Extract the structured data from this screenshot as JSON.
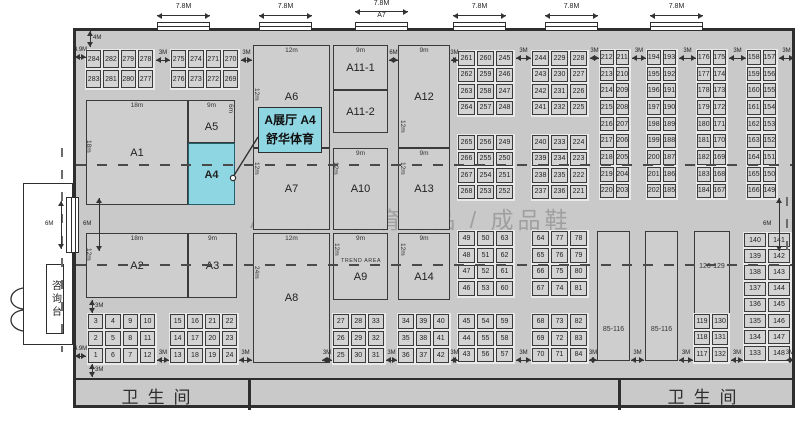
{
  "watermark": {
    "left": "A展厅",
    "right": "体育用品 / 成品鞋"
  },
  "callout": {
    "line1": "A展厅 A4",
    "line2": "舒华体育",
    "target": "A4"
  },
  "annex": {
    "desk_label": "咨询台",
    "door_dim": "6M"
  },
  "restroom": {
    "left_label": "卫生间",
    "right_label": "卫生间",
    "dividers": [
      248,
      618
    ]
  },
  "trend_area_label": "TREND AREA",
  "colors": {
    "hall_bg": "#c9c9c9",
    "booth_bg": "#d3d3d3",
    "highlight": "#8fd6e3",
    "wall": "#2e2e2e",
    "watermark": "#a0a0a0"
  },
  "top_doors": {
    "width_label": "7.8M",
    "a7_label": "A7",
    "items": [
      {
        "x": 157
      },
      {
        "x": 259
      },
      {
        "x": 355,
        "sub": "A7"
      },
      {
        "x": 453
      },
      {
        "x": 545
      },
      {
        "x": 650
      }
    ]
  },
  "zones": [
    {
      "id": "A1",
      "x": 86,
      "y": 100,
      "w": 102,
      "h": 105,
      "label": "A1",
      "t": "18m"
    },
    {
      "id": "A5",
      "x": 188,
      "y": 100,
      "w": 47,
      "h": 43,
      "label": "A5",
      "t": "9m",
      "ly": 0.62
    },
    {
      "id": "A4",
      "x": 188,
      "y": 143,
      "w": 47,
      "h": 62,
      "label": "A4",
      "hl": true,
      "ly": 0.52,
      "bold": true
    },
    {
      "id": "A2",
      "x": 86,
      "y": 233,
      "w": 102,
      "h": 65,
      "label": "A2",
      "t": "18m"
    },
    {
      "id": "A3",
      "x": 188,
      "y": 233,
      "w": 49,
      "h": 65,
      "label": "A3",
      "t": "9m"
    },
    {
      "id": "A6",
      "x": 253,
      "y": 45,
      "w": 77,
      "h": 103,
      "label": "A6",
      "t": "12m"
    },
    {
      "id": "A7",
      "x": 253,
      "y": 148,
      "w": 77,
      "h": 82,
      "label": "A7"
    },
    {
      "id": "A8",
      "x": 253,
      "y": 233,
      "w": 77,
      "h": 130,
      "label": "A8",
      "t": "12m"
    },
    {
      "id": "A11-1",
      "x": 333,
      "y": 45,
      "w": 55,
      "h": 45,
      "label": "A11-1",
      "t": "9m"
    },
    {
      "id": "A11-2",
      "x": 333,
      "y": 90,
      "w": 55,
      "h": 43,
      "label": "A11-2"
    },
    {
      "id": "A10",
      "x": 333,
      "y": 148,
      "w": 55,
      "h": 82,
      "label": "A10",
      "t": "9m"
    },
    {
      "id": "A9",
      "x": 333,
      "y": 233,
      "w": 55,
      "h": 67,
      "label": "A9",
      "t": "9m",
      "ly": 0.66
    },
    {
      "id": "A12",
      "x": 398,
      "y": 45,
      "w": 52,
      "h": 103,
      "label": "A12",
      "t": "9m"
    },
    {
      "id": "A13",
      "x": 398,
      "y": 148,
      "w": 52,
      "h": 82,
      "label": "A13",
      "t": "9m"
    },
    {
      "id": "A14",
      "x": 398,
      "y": 233,
      "w": 52,
      "h": 67,
      "label": "A14",
      "t": "9m",
      "ly": 0.66
    },
    {
      "id": "85-116-a",
      "x": 597,
      "y": 231,
      "w": 33,
      "h": 130,
      "label": "85-116",
      "small": true,
      "ly": 0.78
    },
    {
      "id": "85-116-b",
      "x": 645,
      "y": 231,
      "w": 33,
      "h": 130,
      "label": "85-116",
      "small": true,
      "ly": 0.78
    },
    {
      "id": "120-129",
      "x": 694,
      "y": 231,
      "w": 36,
      "h": 84,
      "label": "120-129",
      "small": true,
      "ly": 0.45
    }
  ],
  "booth_grids": [
    {
      "id": "g-284",
      "x": 86,
      "y": 50,
      "cw": 17.3,
      "ch": 20,
      "rows": [
        [
          284,
          282,
          279,
          278
        ],
        [
          283,
          281,
          280,
          277
        ]
      ]
    },
    {
      "id": "g-275",
      "x": 171,
      "y": 50,
      "cw": 17.3,
      "ch": 20,
      "rows": [
        [
          275,
          274,
          271,
          270
        ],
        [
          276,
          273,
          272,
          269
        ]
      ]
    },
    {
      "id": "g-261",
      "x": 458,
      "y": 51,
      "cw": 19,
      "ch": 16.5,
      "rows": [
        [
          261,
          260,
          245
        ],
        [
          262,
          259,
          246
        ],
        [
          263,
          258,
          247
        ],
        [
          264,
          257,
          248
        ]
      ]
    },
    {
      "id": "g-265",
      "x": 458,
      "y": 135,
      "cw": 19,
      "ch": 16.5,
      "rows": [
        [
          265,
          256,
          249
        ],
        [
          266,
          255,
          250
        ],
        [
          267,
          254,
          251
        ],
        [
          268,
          253,
          252
        ]
      ]
    },
    {
      "id": "g-244",
      "x": 532,
      "y": 51,
      "cw": 19,
      "ch": 16.5,
      "rows": [
        [
          244,
          229,
          228
        ],
        [
          243,
          230,
          227
        ],
        [
          242,
          231,
          226
        ],
        [
          241,
          232,
          225
        ]
      ]
    },
    {
      "id": "g-240",
      "x": 532,
      "y": 135,
      "cw": 19,
      "ch": 16.5,
      "rows": [
        [
          240,
          233,
          224
        ],
        [
          239,
          234,
          223
        ],
        [
          238,
          235,
          222
        ],
        [
          237,
          236,
          221
        ]
      ]
    },
    {
      "id": "c-212",
      "x": 600,
      "y": 50,
      "cw": 15.5,
      "ch": 16.7,
      "rows": [
        [
          212,
          211
        ],
        [
          213,
          210
        ],
        [
          214,
          209
        ],
        [
          215,
          208
        ],
        [
          216,
          207
        ],
        [
          217,
          206
        ],
        [
          218,
          205
        ],
        [
          219,
          204
        ],
        [
          220,
          203
        ]
      ]
    },
    {
      "id": "c-194",
      "x": 647,
      "y": 50,
      "cw": 15.5,
      "ch": 16.7,
      "rows": [
        [
          194,
          193
        ],
        [
          195,
          192
        ],
        [
          196,
          191
        ],
        [
          197,
          190
        ],
        [
          198,
          189
        ],
        [
          199,
          188
        ],
        [
          200,
          187
        ],
        [
          201,
          186
        ],
        [
          202,
          185
        ]
      ]
    },
    {
      "id": "c-176",
      "x": 697,
      "y": 50,
      "cw": 15.5,
      "ch": 16.7,
      "rows": [
        [
          176,
          175
        ],
        [
          177,
          174
        ],
        [
          178,
          173
        ],
        [
          179,
          172
        ],
        [
          180,
          171
        ],
        [
          181,
          170
        ],
        [
          182,
          169
        ],
        [
          183,
          168
        ],
        [
          184,
          167
        ]
      ]
    },
    {
      "id": "c-158",
      "x": 747,
      "y": 50,
      "cw": 15.5,
      "ch": 16.7,
      "rows": [
        [
          158,
          157
        ],
        [
          159,
          156
        ],
        [
          160,
          155
        ],
        [
          161,
          154
        ],
        [
          162,
          153
        ],
        [
          163,
          152
        ],
        [
          164,
          151
        ],
        [
          165,
          150
        ],
        [
          166,
          149
        ]
      ]
    },
    {
      "id": "g-1",
      "x": 88,
      "y": 314,
      "cw": 17.3,
      "ch": 17,
      "rows": [
        [
          3,
          4,
          9,
          10
        ],
        [
          2,
          5,
          8,
          11
        ],
        [
          1,
          6,
          7,
          12
        ]
      ]
    },
    {
      "id": "g-13",
      "x": 170,
      "y": 314,
      "cw": 17.3,
      "ch": 17,
      "rows": [
        [
          15,
          16,
          21,
          22
        ],
        [
          14,
          17,
          20,
          23
        ],
        [
          13,
          18,
          19,
          24
        ]
      ]
    },
    {
      "id": "g-25",
      "x": 333,
      "y": 314,
      "cw": 17.5,
      "ch": 17,
      "rows": [
        [
          27,
          28,
          33
        ],
        [
          26,
          29,
          32
        ],
        [
          25,
          30,
          31
        ]
      ]
    },
    {
      "id": "g-34",
      "x": 398,
      "y": 314,
      "cw": 17.5,
      "ch": 17,
      "rows": [
        [
          34,
          39,
          40
        ],
        [
          35,
          38,
          41
        ],
        [
          36,
          37,
          42
        ]
      ]
    },
    {
      "id": "g-49",
      "x": 458,
      "y": 231,
      "cw": 19,
      "ch": 16.8,
      "rows": [
        [
          49,
          50,
          63
        ],
        [
          48,
          51,
          62
        ],
        [
          47,
          52,
          61
        ],
        [
          46,
          53,
          60
        ]
      ]
    },
    {
      "id": "g-43",
      "x": 458,
      "y": 314,
      "cw": 19,
      "ch": 16.8,
      "rows": [
        [
          45,
          54,
          59
        ],
        [
          44,
          55,
          58
        ],
        [
          43,
          56,
          57
        ]
      ]
    },
    {
      "id": "g-64",
      "x": 532,
      "y": 231,
      "cw": 19,
      "ch": 16.8,
      "rows": [
        [
          64,
          77,
          78
        ],
        [
          65,
          76,
          79
        ],
        [
          66,
          75,
          80
        ],
        [
          67,
          74,
          81
        ]
      ]
    },
    {
      "id": "g-68",
      "x": 532,
      "y": 314,
      "cw": 19,
      "ch": 16.8,
      "rows": [
        [
          68,
          73,
          82
        ],
        [
          69,
          72,
          83
        ],
        [
          70,
          71,
          84
        ]
      ]
    },
    {
      "id": "c-119",
      "x": 694,
      "y": 314,
      "cw": 18,
      "ch": 16.5,
      "rows": [
        [
          119,
          130
        ],
        [
          118,
          131
        ],
        [
          117,
          132
        ]
      ]
    },
    {
      "id": "c-140",
      "x": 744,
      "y": 233,
      "cw": 24,
      "ch": 16.2,
      "rows": [
        [
          140,
          141
        ],
        [
          139,
          142
        ],
        [
          138,
          143
        ],
        [
          137,
          144
        ],
        [
          136,
          145
        ],
        [
          135,
          146
        ],
        [
          134,
          147
        ],
        [
          133,
          148
        ]
      ]
    }
  ],
  "dims": [
    {
      "o": "v",
      "x": 90,
      "y": 31,
      "len": 16,
      "label": "4M",
      "lp": "r"
    },
    {
      "o": "h",
      "x": 75,
      "y": 57,
      "len": 11,
      "label": "4.9M"
    },
    {
      "o": "h",
      "x": 156,
      "y": 60,
      "len": 14,
      "label": "3M"
    },
    {
      "o": "h",
      "x": 241,
      "y": 60,
      "len": 11,
      "label": "3M"
    },
    {
      "o": "h",
      "x": 389,
      "y": 60,
      "len": 9,
      "label": "6M"
    },
    {
      "o": "h",
      "x": 451,
      "y": 60,
      "len": 7,
      "label": "3M"
    },
    {
      "o": "h",
      "x": 516,
      "y": 58,
      "len": 15,
      "label": "3M"
    },
    {
      "o": "h",
      "x": 590,
      "y": 58,
      "len": 9,
      "label": "3M"
    },
    {
      "o": "h",
      "x": 632,
      "y": 58,
      "len": 14,
      "label": "3M"
    },
    {
      "o": "h",
      "x": 679,
      "y": 58,
      "len": 17,
      "label": "3M"
    },
    {
      "o": "h",
      "x": 729,
      "y": 58,
      "len": 17,
      "label": "3M"
    },
    {
      "o": "h",
      "x": 779,
      "y": 58,
      "len": 15,
      "label": "3M"
    },
    {
      "o": "v",
      "x": 99,
      "y": 198,
      "len": 53,
      "label": "6M",
      "lp": "l"
    },
    {
      "o": "v",
      "x": 61,
      "y": 201,
      "len": 48,
      "label": "6M",
      "lp": "l"
    },
    {
      "o": "v",
      "x": 779,
      "y": 198,
      "len": 53,
      "label": "6M",
      "lp": "l"
    },
    {
      "o": "v",
      "x": 92,
      "y": 300,
      "len": 13,
      "label": "3M",
      "lp": "r"
    },
    {
      "o": "v",
      "x": 92,
      "y": 364,
      "len": 13,
      "label": "3M",
      "lp": "r"
    },
    {
      "o": "h",
      "x": 75,
      "y": 356,
      "len": 11,
      "label": "4.9M"
    },
    {
      "o": "h",
      "x": 157,
      "y": 360,
      "len": 12,
      "label": "3M"
    },
    {
      "o": "h",
      "x": 239,
      "y": 360,
      "len": 13,
      "label": "3M"
    },
    {
      "o": "h",
      "x": 322,
      "y": 360,
      "len": 10,
      "label": "3M"
    },
    {
      "o": "h",
      "x": 386,
      "y": 360,
      "len": 11,
      "label": "3M"
    },
    {
      "o": "h",
      "x": 451,
      "y": 360,
      "len": 7,
      "label": "3M"
    },
    {
      "o": "h",
      "x": 516,
      "y": 360,
      "len": 15,
      "label": "3M"
    },
    {
      "o": "h",
      "x": 589,
      "y": 360,
      "len": 8,
      "label": "3M"
    },
    {
      "o": "h",
      "x": 631,
      "y": 360,
      "len": 13,
      "label": "3M"
    },
    {
      "o": "h",
      "x": 679,
      "y": 360,
      "len": 14,
      "label": "3M"
    },
    {
      "o": "h",
      "x": 731,
      "y": 360,
      "len": 12,
      "label": "3M"
    },
    {
      "o": "h",
      "x": 786,
      "y": 360,
      "len": 8,
      "label": "3M"
    }
  ],
  "rot_labels": [
    {
      "x": 85,
      "y": 140,
      "t": "18m"
    },
    {
      "x": 85,
      "y": 248,
      "t": "12m"
    },
    {
      "x": 253,
      "y": 88,
      "t": "12m"
    },
    {
      "x": 253,
      "y": 162,
      "t": "12m"
    },
    {
      "x": 253,
      "y": 266,
      "t": "24m"
    },
    {
      "x": 227,
      "y": 104,
      "t": "6m"
    },
    {
      "x": 332,
      "y": 162,
      "t": "12m"
    },
    {
      "x": 333,
      "y": 243,
      "t": "12m"
    },
    {
      "x": 399,
      "y": 120,
      "t": "12m"
    },
    {
      "x": 399,
      "y": 162,
      "t": "12m"
    },
    {
      "x": 399,
      "y": 243,
      "t": "12m"
    }
  ],
  "aisles": {
    "h": [
      {
        "x": 76,
        "y": 164,
        "len": 716
      },
      {
        "x": 76,
        "y": 264,
        "len": 716
      }
    ],
    "v": [
      {
        "x": 61,
        "y": 148,
        "len": 204
      },
      {
        "x": 786,
        "y": 197,
        "len": 56
      }
    ]
  }
}
